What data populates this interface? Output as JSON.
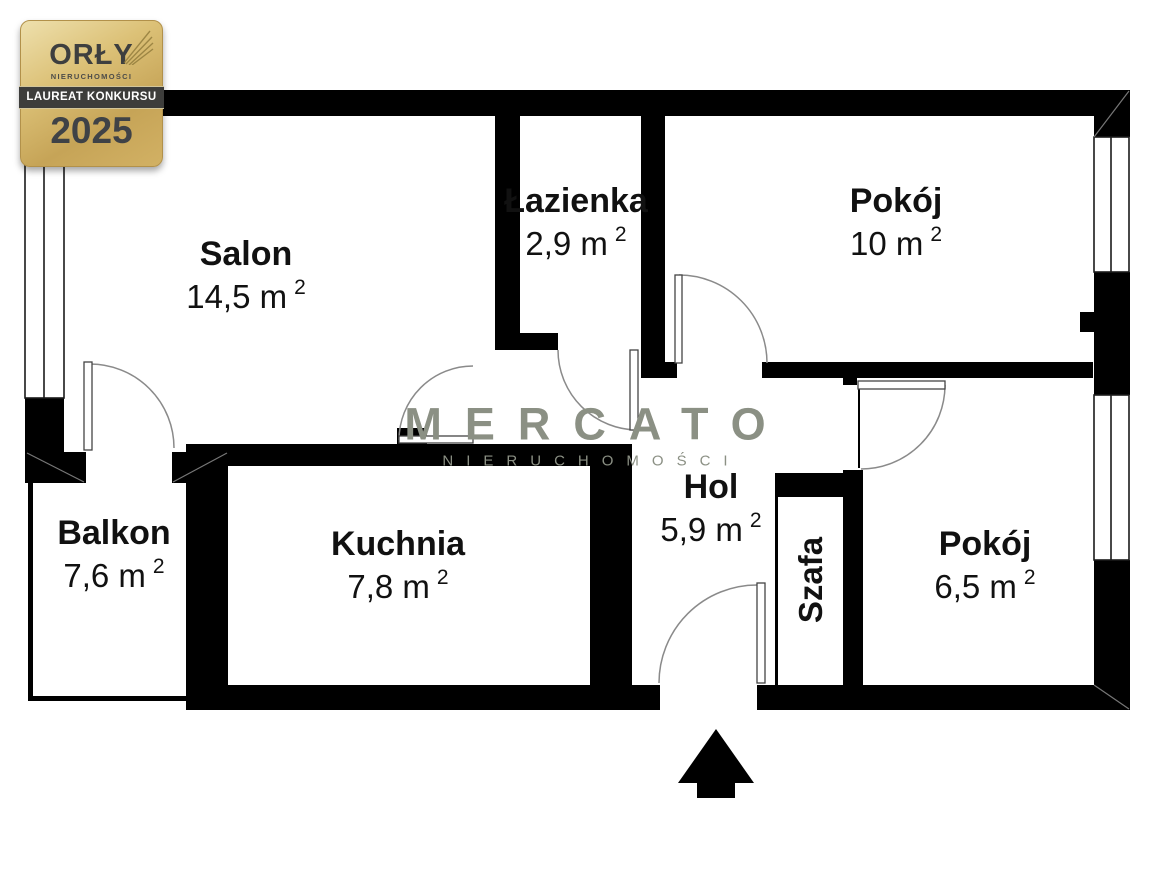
{
  "badge": {
    "title": "ORŁY",
    "subtitle": "NIERUCHOMOŚCI",
    "band": "LAUREAT KONKURSU",
    "year": "2025"
  },
  "watermark": {
    "brand": "MERCATO",
    "sub": "NIERUCHOMOŚCI"
  },
  "rooms": [
    {
      "id": "salon",
      "name": "Salon",
      "area": "14,5 m",
      "sup": "2"
    },
    {
      "id": "lazienka",
      "name": "Łazienka",
      "area": "2,9 m",
      "sup": "2"
    },
    {
      "id": "pokoj-10",
      "name": "Pokój",
      "area": "10 m",
      "sup": "2"
    },
    {
      "id": "balkon",
      "name": "Balkon",
      "area": "7,6 m",
      "sup": "2"
    },
    {
      "id": "kuchnia",
      "name": "Kuchnia",
      "area": "7,8 m",
      "sup": "2"
    },
    {
      "id": "hol",
      "name": "Hol",
      "area": "5,9 m",
      "sup": "2"
    },
    {
      "id": "pokoj-65",
      "name": "Pokój",
      "area": "6,5 m",
      "sup": "2"
    },
    {
      "id": "szafa",
      "name": "Szafa"
    }
  ],
  "colors": {
    "wall": "#000000",
    "door_arc": "#8a8a8a",
    "watermark": "#8b9084",
    "badge_gold": "#d0b062",
    "badge_band_bg": "#3d3d3b"
  }
}
